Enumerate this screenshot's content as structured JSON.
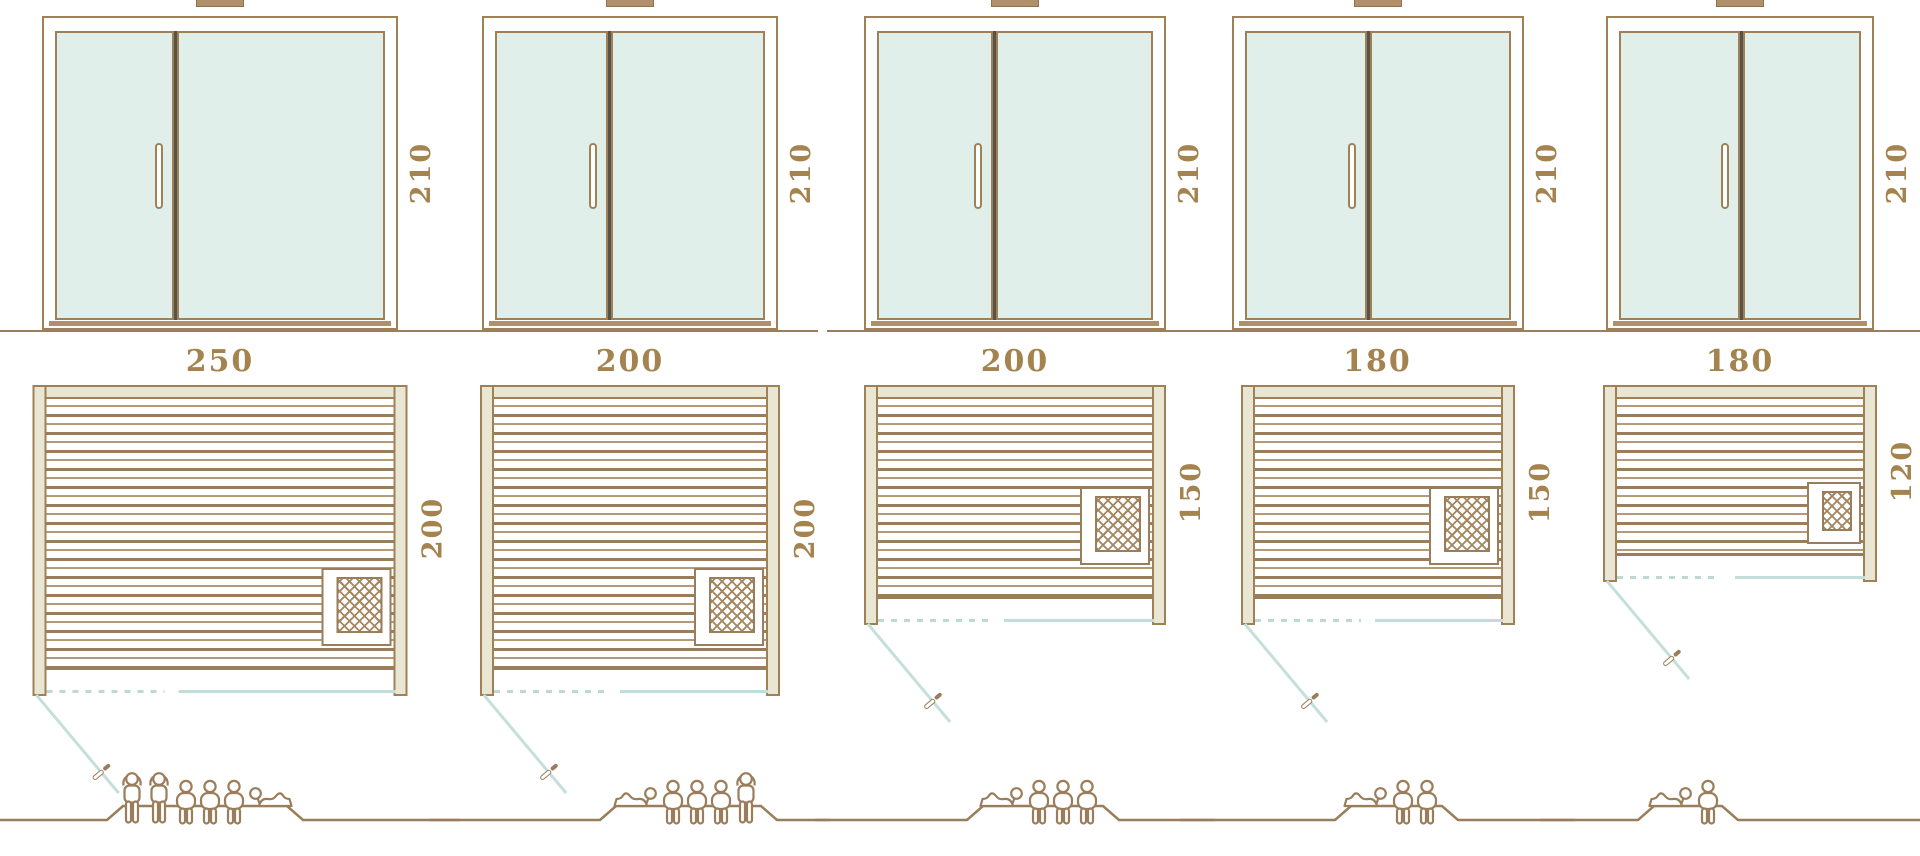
{
  "colors": {
    "line_brown": "#9a7d5a",
    "frame_brown": "#a08055",
    "label_gold": "#a5834f",
    "glass_teal": "#e1efeb",
    "door_line_teal": "#c2dedb",
    "wall_beige": "#e9e6d3",
    "sill_tan": "#b0906a"
  },
  "columns": [
    {
      "name": "sauna-250x200",
      "elevation": {
        "height_label": "210"
      },
      "plan": {
        "width_label": "250",
        "depth_label": "200"
      },
      "capacity": {
        "standing": 2,
        "sitting": 3,
        "lying": 1,
        "total": 6
      }
    },
    {
      "name": "sauna-200x200",
      "elevation": {
        "height_label": "210"
      },
      "plan": {
        "width_label": "200",
        "depth_label": "200"
      },
      "capacity": {
        "standing": 1,
        "sitting": 3,
        "lying": 1,
        "total": 5
      }
    },
    {
      "name": "sauna-200x150",
      "elevation": {
        "height_label": "210"
      },
      "plan": {
        "width_label": "200",
        "depth_label": "150"
      },
      "capacity": {
        "standing": 0,
        "sitting": 3,
        "lying": 1,
        "total": 4
      }
    },
    {
      "name": "sauna-180x150",
      "elevation": {
        "height_label": "210"
      },
      "plan": {
        "width_label": "180",
        "depth_label": "150"
      },
      "capacity": {
        "standing": 0,
        "sitting": 2,
        "lying": 1,
        "total": 3
      }
    },
    {
      "name": "sauna-180x120",
      "elevation": {
        "height_label": "210"
      },
      "plan": {
        "width_label": "180",
        "depth_label": "120"
      },
      "capacity": {
        "standing": 0,
        "sitting": 1,
        "lying": 1,
        "total": 2
      }
    }
  ]
}
